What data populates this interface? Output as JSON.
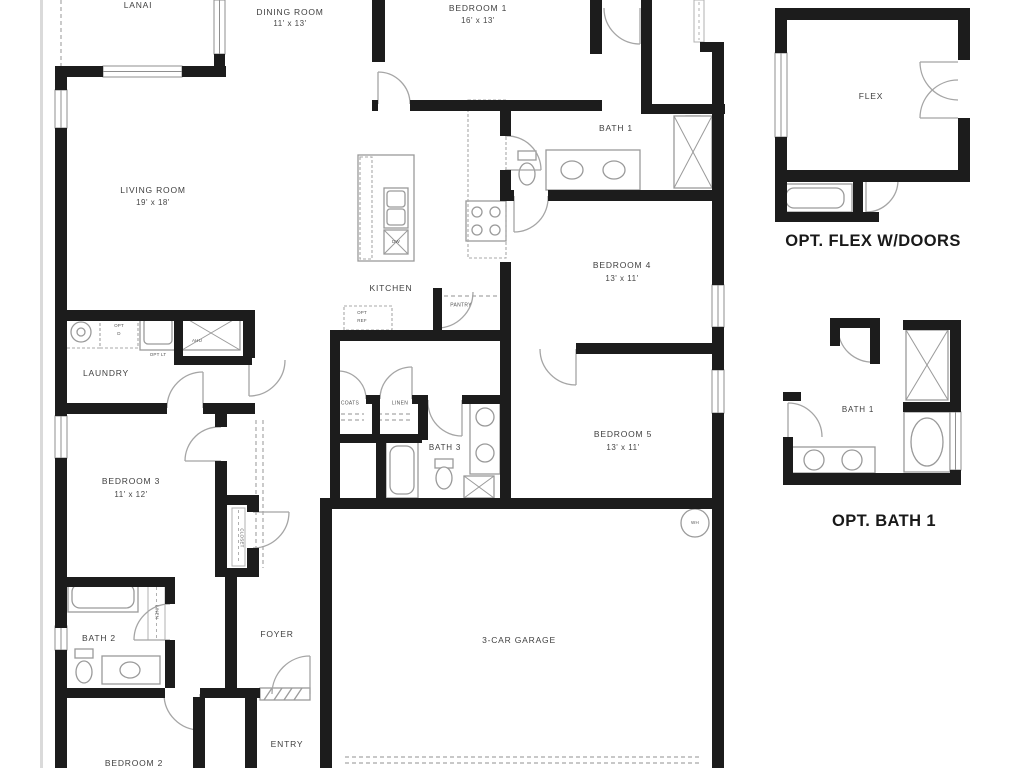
{
  "plan": {
    "rooms": {
      "lanai": {
        "name": "LANAI"
      },
      "dining": {
        "name": "DINING ROOM",
        "dims": "11' x 13'"
      },
      "bedroom1": {
        "name": "BEDROOM 1",
        "dims": "16' x 13'"
      },
      "bath1": {
        "name": "BATH 1"
      },
      "living": {
        "name": "LIVING ROOM",
        "dims": "19' x 18'"
      },
      "kitchen": {
        "name": "KITCHEN"
      },
      "pantry": {
        "name": "PANTRY"
      },
      "bedroom4": {
        "name": "BEDROOM 4",
        "dims": "13' x 11'"
      },
      "bedroom5": {
        "name": "BEDROOM 5",
        "dims": "13' x 11'"
      },
      "laundry": {
        "name": "LAUNDRY"
      },
      "bedroom3": {
        "name": "BEDROOM 3",
        "dims": "11' x 12'"
      },
      "bath3": {
        "name": "BATH 3"
      },
      "bath2": {
        "name": "BATH 2"
      },
      "foyer": {
        "name": "FOYER"
      },
      "entry": {
        "name": "ENTRY"
      },
      "garage": {
        "name": "3-CAR GARAGE"
      },
      "bedroom2": {
        "name": "BEDROOM 2"
      }
    },
    "closets": {
      "coats": "COATS",
      "linen_hall": "LINEN",
      "closet_bed3": "CLOSET",
      "linen_bath2": "LINEN"
    },
    "fixtures": {
      "ahu": "AHU",
      "opt_ref_line1": "OPT",
      "opt_ref_line2": "REF",
      "opt_d_line1": "OPT",
      "opt_d_line2": "D",
      "opt_lt": "OPT LT",
      "dw": "DW",
      "wh": "WH"
    },
    "insets": {
      "flex": {
        "room": "FLEX",
        "caption": "OPT. FLEX W/DOORS"
      },
      "opt_bath": {
        "room": "BATH 1",
        "caption": "OPT. BATH 1"
      }
    },
    "colors": {
      "wall": "#1c1c1c",
      "fixture": "#9a9a9a",
      "dash": "#a8a8a8",
      "text": "#3f3f3f",
      "background": "#ffffff"
    }
  }
}
